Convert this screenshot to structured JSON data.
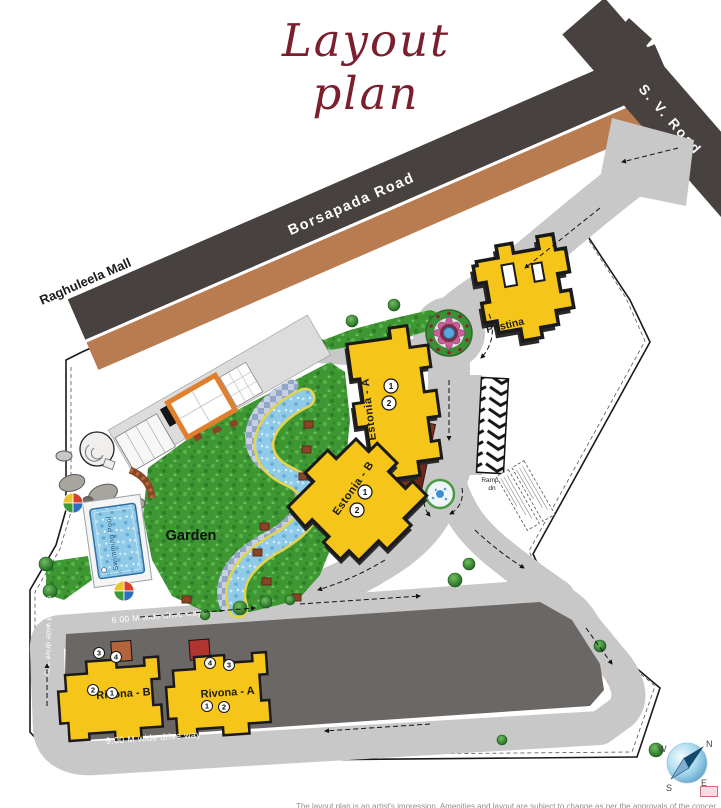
{
  "title": "Layout plan",
  "roads": {
    "sv_road": "S. V. Road",
    "borsapada_road": "Borsapada Road",
    "raghuleela_mall": "Raghuleela Mall",
    "drive_way_top": "6.00 M wide drive way",
    "drive_way_bottom": "9.00 M wide drive way",
    "drive_way_left": "6.00 M wide drive way"
  },
  "buildings": {
    "pristina": {
      "label": "Pristina"
    },
    "estonia_a": {
      "label": "Estonia - A",
      "wings": [
        "1",
        "2"
      ]
    },
    "estonia_b": {
      "label": "Estonia - B",
      "wings": [
        "1",
        "2"
      ]
    },
    "rivona_b": {
      "label": "Rivona - B",
      "wings": [
        "3",
        "4",
        "2",
        "1"
      ]
    },
    "rivona_a": {
      "label": "Rivona - A",
      "wings": [
        "4",
        "3",
        "1",
        "2"
      ]
    }
  },
  "amenities": {
    "garden": "Garden",
    "swimming_pool": "Swimming Pool",
    "ramp_line1": "Ramp",
    "ramp_line2": "dn"
  },
  "compass": {
    "north": "N",
    "east": "E",
    "south": "S",
    "west": "W"
  },
  "footer_note": "The layout plan is an artist's impression. Amenities and layout are subject to change as per the approvals of the concerned authorities.",
  "colors": {
    "title_maroon": "#7c1f2d",
    "building_yellow": "#F6C51A",
    "road_dark": "#474140",
    "verge_brown": "#B97B50",
    "road_light": "#C8C8C8",
    "garden_green": "#3F9733",
    "water_blue": "#8FCBE8"
  }
}
